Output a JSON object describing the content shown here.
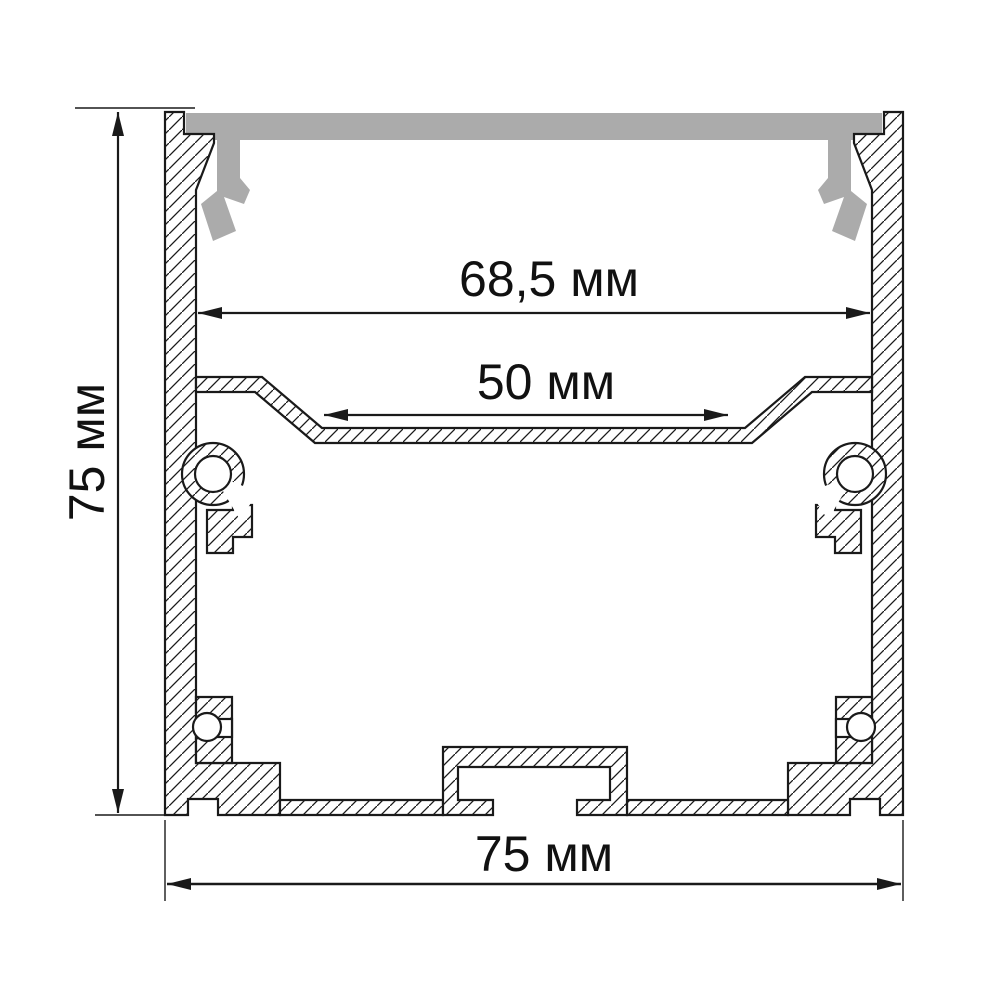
{
  "drawing": {
    "kind": "aluminium LED profile cross-section",
    "dimensions": {
      "top_inner_width": "68,5 мм",
      "channel_width": "50 мм",
      "height": "75 мм",
      "bottom_width": "75 мм"
    },
    "colors": {
      "line": "#1a1a1a",
      "cover": "#ababab",
      "background": "#ffffff"
    }
  }
}
